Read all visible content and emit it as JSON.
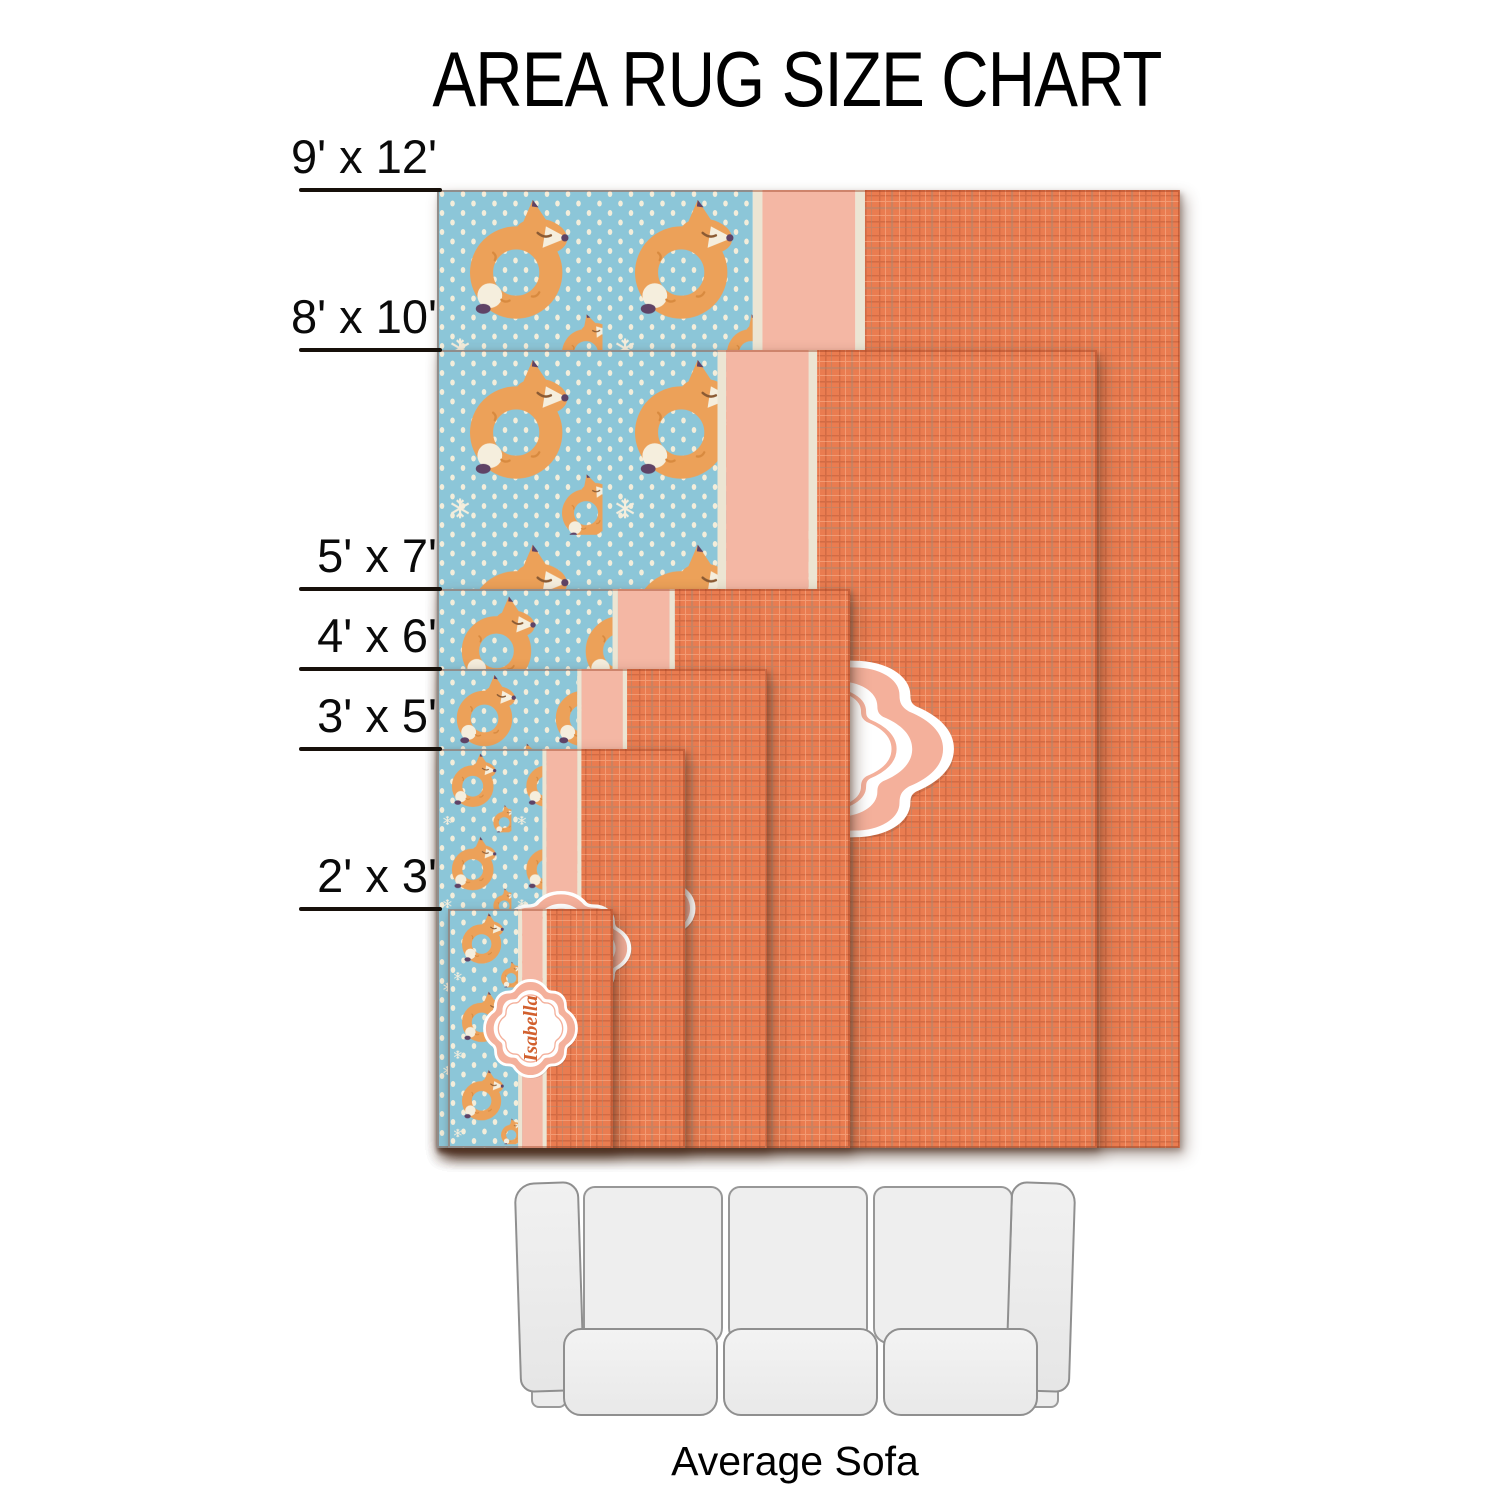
{
  "title": "AREA RUG SIZE CHART",
  "rug_design_name": "Isabella",
  "sofa_label": "Average Sofa",
  "rugs": [
    {
      "label": "9' x 12'",
      "width_ft": 9,
      "height_ft": 12
    },
    {
      "label": "8' x 10'",
      "width_ft": 8,
      "height_ft": 10
    },
    {
      "label": "5' x 7'",
      "width_ft": 5,
      "height_ft": 7
    },
    {
      "label": "4' x 6'",
      "width_ft": 4,
      "height_ft": 6
    },
    {
      "label": "3' x 5'",
      "width_ft": 3,
      "height_ft": 5
    },
    {
      "label": "2' x 3'",
      "width_ft": 2,
      "height_ft": 3
    }
  ],
  "colors": {
    "fox_bg_teal": "#8cc6d8",
    "dot_cream": "#f3edda",
    "peach_stripe": "#f4b7a4",
    "cream_line": "#ece5d3",
    "linen_orange": "#ea7c50",
    "linen_line_dark": "#bd5c39",
    "linen_line_gray": "#a98872",
    "linen_line_light": "#ffc0a0",
    "badge_peach": "#f4b09b",
    "badge_text": "#d2602e",
    "fox_orange": "#eca159",
    "fox_white": "#f5eedd",
    "fox_purple": "#5f4366",
    "rug_edge": "#96371a",
    "label_black": "#17100a",
    "sofa_fill": "#ededed",
    "sofa_stroke": "#8f8f8f"
  }
}
